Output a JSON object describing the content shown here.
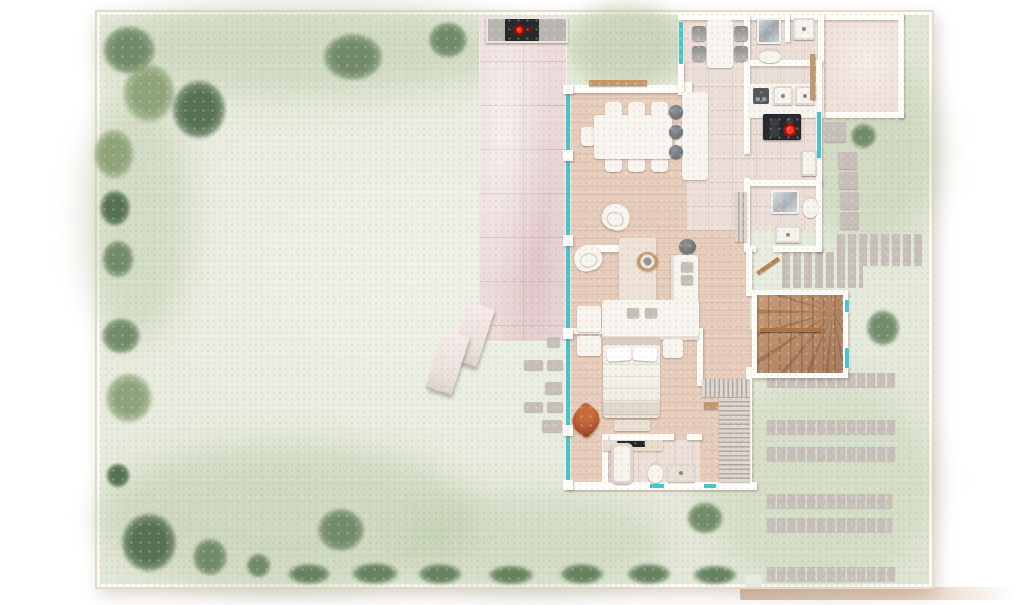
{
  "title": "Watercolor ground-floor site plan of a villa with garden",
  "colors": {
    "lawn": "#e7ebdd",
    "lawn_shade": "#b9c8a6",
    "tree_dark": "#4f6b4b",
    "tree_mid": "#6c8662",
    "tree_light": "#8ba075",
    "hedge": "#5c7a55",
    "terrace": "#ecdbda",
    "terrace_line": "#d4bdbc",
    "wood_floor": "#e7cdbb",
    "wood_line": "#c99f86",
    "tile_floor": "#ecdfd8",
    "entry_floor": "#efe0d9",
    "wall": "#fffefb",
    "window_teal": "#47c4cc",
    "stair_wood": "#bd8f6d",
    "handrail": "#b5703c",
    "paving": "#c8bfbb",
    "rust": "#ab4d28",
    "counter_dark": "#26282b",
    "burner_red": "#e32317",
    "stool_grey": "#70767a",
    "road": "#dcc2ae",
    "boundary": "#e9d9c7",
    "furniture": "#f8f4ef"
  },
  "site": {
    "boundary": "cream wall around rectangular plot, gate opening at bottom right",
    "tree_blobs": 18,
    "hedge_blobs": 7,
    "sun_loungers": 2,
    "driveway_paver_rows": 6,
    "stepping_stone_columns": 2,
    "path_stones": 6,
    "terrace": "pink stone terrace with bbq counter at top edge, red burner glow"
  },
  "house": {
    "rooms": [
      {
        "name": "dining room",
        "furniture": "table with 8 chairs, island counter with 3 bar stools, wall shelf"
      },
      {
        "name": "kitchen",
        "furniture": "double sink counter, coffee machine, cooktop with 4 burners (one glowing red), fridge"
      },
      {
        "name": "breakfast nook",
        "furniture": "table with 4 grey chairs"
      },
      {
        "name": "laundry bath",
        "furniture": "shower, washbasin, toilet"
      },
      {
        "name": "entrance hall",
        "furniture": "empty pink-floored room, wall bench"
      },
      {
        "name": "guest shower room",
        "furniture": "glass shower, toilet, vanity, louvered radiator"
      },
      {
        "name": "living room",
        "furniture": "L-shaped sofa with cushions, 2 armchairs, rug, round side table, grey stool, side tables"
      },
      {
        "name": "bedroom",
        "furniture": "double bed, nightstands, foot bench, rust butterfly chair, TV sideboard, L-shaped louvered wardrobe"
      },
      {
        "name": "ensuite bath",
        "furniture": "bathtub, toilet, vanity"
      },
      {
        "name": "staircase",
        "furniture": "L-winder wooden stairs with handrail"
      }
    ],
    "glazing": "floor-to-ceiling teal window strips on west facade, kitchen east wall, stair wall, bath south walls"
  }
}
